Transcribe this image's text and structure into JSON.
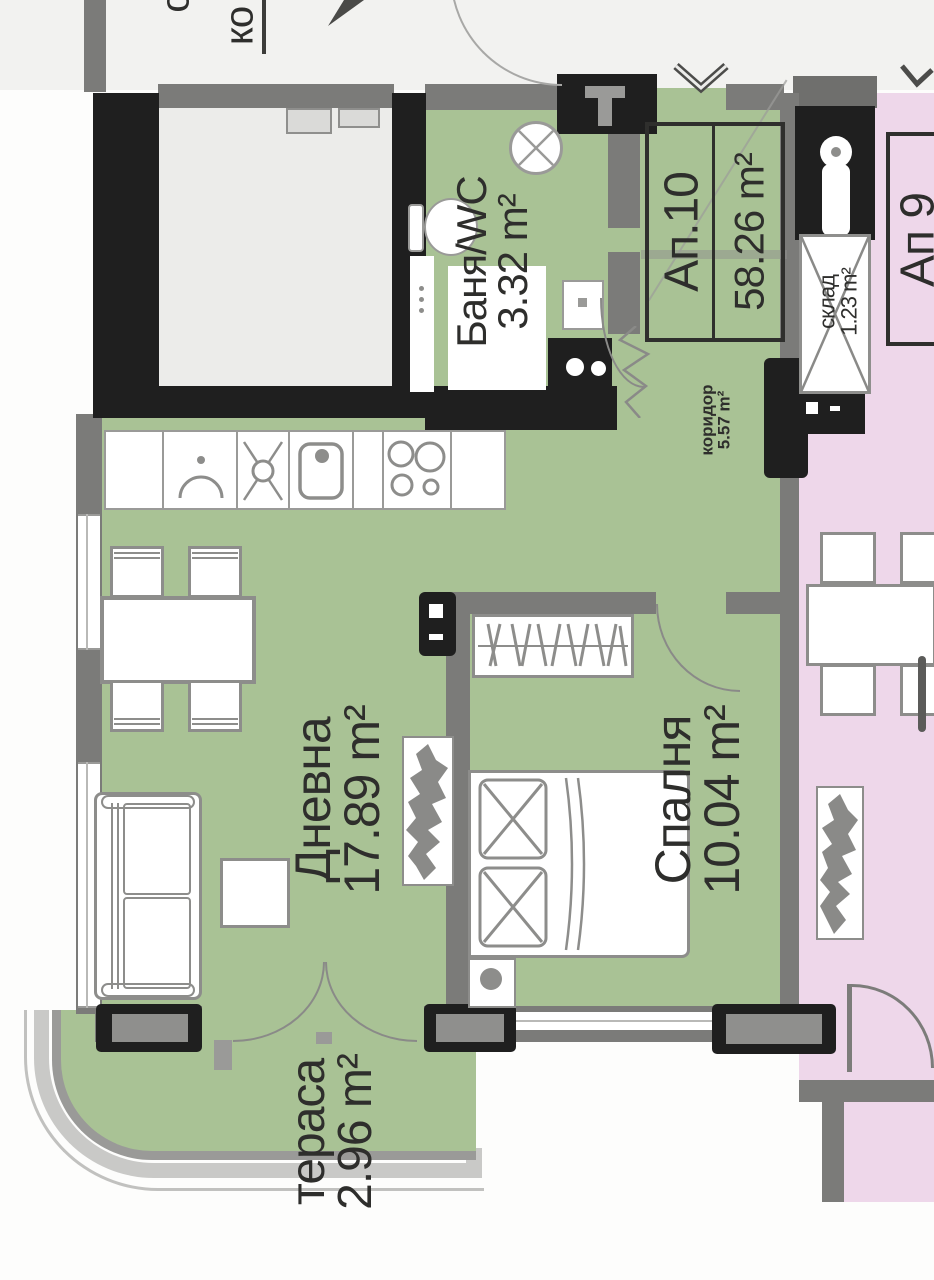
{
  "document": {
    "type": "apartment floor plan"
  },
  "apartment": {
    "id": "Ап.10",
    "area": "58.26 m²"
  },
  "neighbor": {
    "id": "Ап 9"
  },
  "rooms": {
    "bathroom": {
      "name": "Баня/WC",
      "area": "3.32 m²"
    },
    "corridor": {
      "name": "коридор",
      "area": "5.57 m²"
    },
    "living": {
      "name": "Дневна",
      "area": "17.89 m²"
    },
    "bedroom": {
      "name": "Спалня",
      "area": "10.04 m²"
    },
    "terrace": {
      "name": "тераса",
      "area": "2.96 m²"
    },
    "storage": {
      "name": "склад",
      "area": "1.23 m²"
    }
  },
  "fragments": {
    "common_area_label": "ко",
    "common_area_label_partial": "о"
  },
  "colors": {
    "apartment_floor": "#a9c295",
    "neighbor_floor": "#eed7ea",
    "wall_gray": "#7b7b79",
    "wall_black": "#1f1f1f",
    "terrace_band": "#c9c9c7",
    "label_text": "#2e2e2c"
  }
}
